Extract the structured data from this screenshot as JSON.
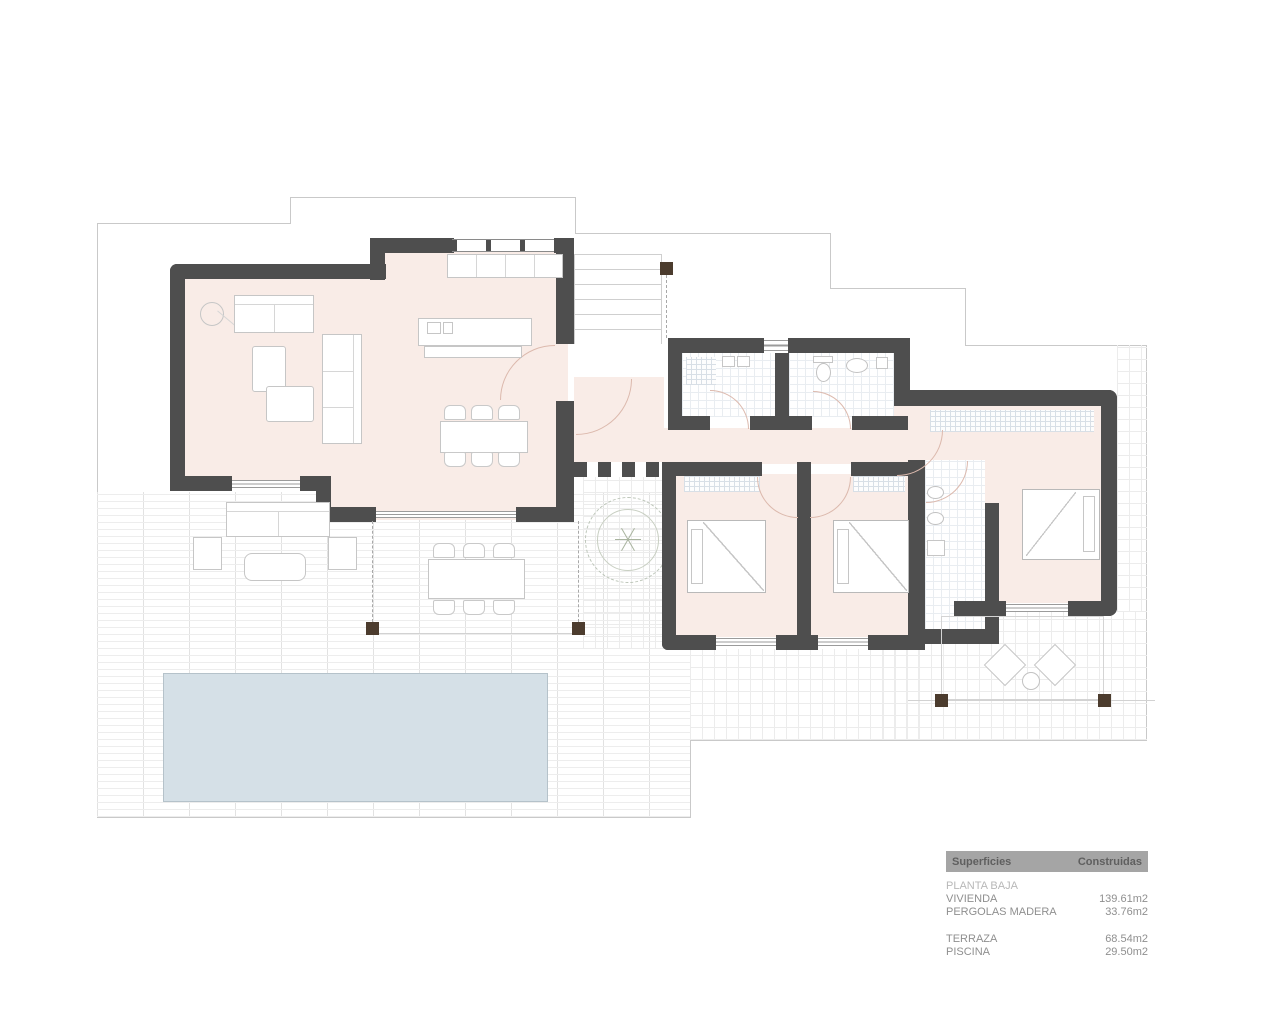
{
  "legend": {
    "columns": {
      "left": "Superficies",
      "right": "Construidas"
    },
    "section": "PLANTA BAJA",
    "rows": [
      {
        "label": "VIVIENDA",
        "value": "139.61m2"
      },
      {
        "label": "PERGOLAS MADERA",
        "value": "33.76m2"
      },
      {
        "label": "TERRAZA",
        "value": "68.54m2"
      },
      {
        "label": "PISCINA",
        "value": "29.50m2"
      }
    ]
  },
  "colors": {
    "wall": "#4e4e4e",
    "room_floor": "#f9ece7",
    "pool": "#d5e0e7",
    "pergola_post": "#4c3c2e",
    "legend_header_bg": "#a5a5a5",
    "door_arc": "#dcb9ad"
  }
}
